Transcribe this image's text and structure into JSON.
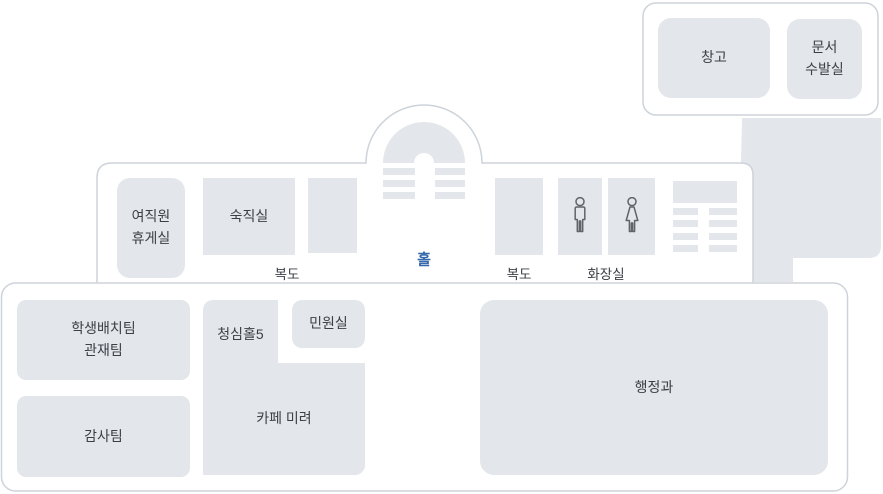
{
  "colors": {
    "room_fill": "#e3e6ea",
    "outline_stroke": "#cdd3da",
    "label_text": "#3b4047",
    "hall_blue": "#3467ab",
    "icon_stroke": "#60656c"
  },
  "annex": {
    "storage": "창고",
    "document_room": "문서\n수발실"
  },
  "upper_floor": {
    "womens_lounge": "여직원\n휴게실",
    "night_duty_room": "숙직실",
    "corridor_left": "복도",
    "hall": "홀",
    "corridor_right": "복도",
    "restroom": "화장실"
  },
  "lower_floor": {
    "student_placement_team": "학생배치팀\n관재팀",
    "audit_team": "감사팀",
    "cheongsim_hall_5": "청심홀5",
    "civil_affairs_office": "민원실",
    "cafe_mirye": "카페 미려",
    "admin_department": "행정과"
  },
  "icons": {
    "male_restroom": "male-pictogram",
    "female_restroom": "female-pictogram"
  }
}
